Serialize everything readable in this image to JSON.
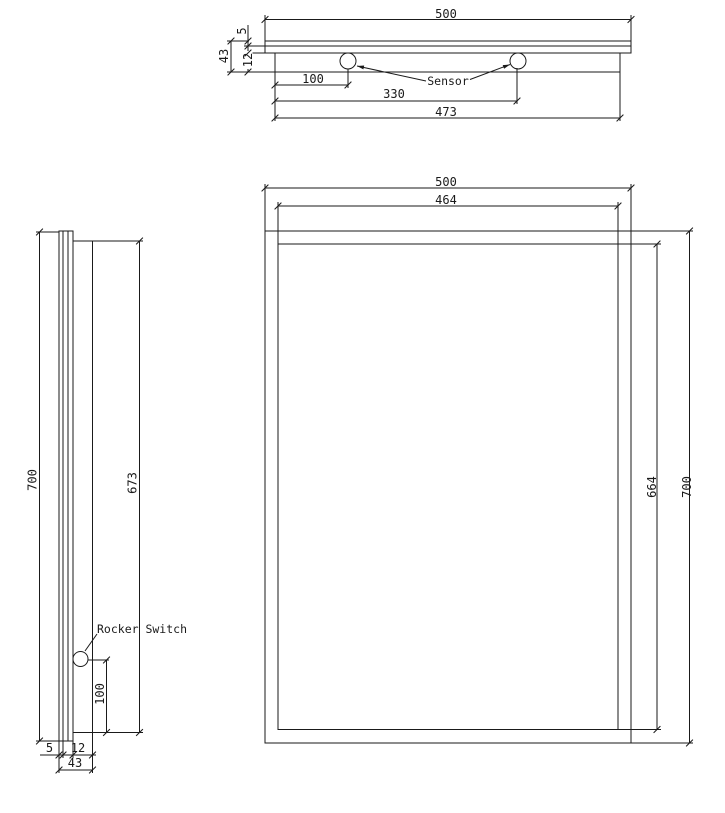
{
  "drawing": {
    "top_view": {
      "overall_width": "500",
      "glass_thickness": "5",
      "overall_depth": "43",
      "box_depth": "12",
      "sensor1_offset": "100",
      "sensor2_offset": "330",
      "body_width": "473",
      "sensor_label": "Sensor"
    },
    "side_view": {
      "overall_height": "700",
      "box_height": "673",
      "switch_offset": "100",
      "glass_thickness": "5",
      "box_depth": "12",
      "overall_depth": "43",
      "switch_label": "Rocker Switch"
    },
    "front_view": {
      "outer_width": "500",
      "inner_width": "464",
      "inner_height": "664",
      "outer_height": "700"
    },
    "colors": {
      "line": "#1a1a1a",
      "hatch": "#6e6e6e",
      "background": "#ffffff"
    }
  }
}
